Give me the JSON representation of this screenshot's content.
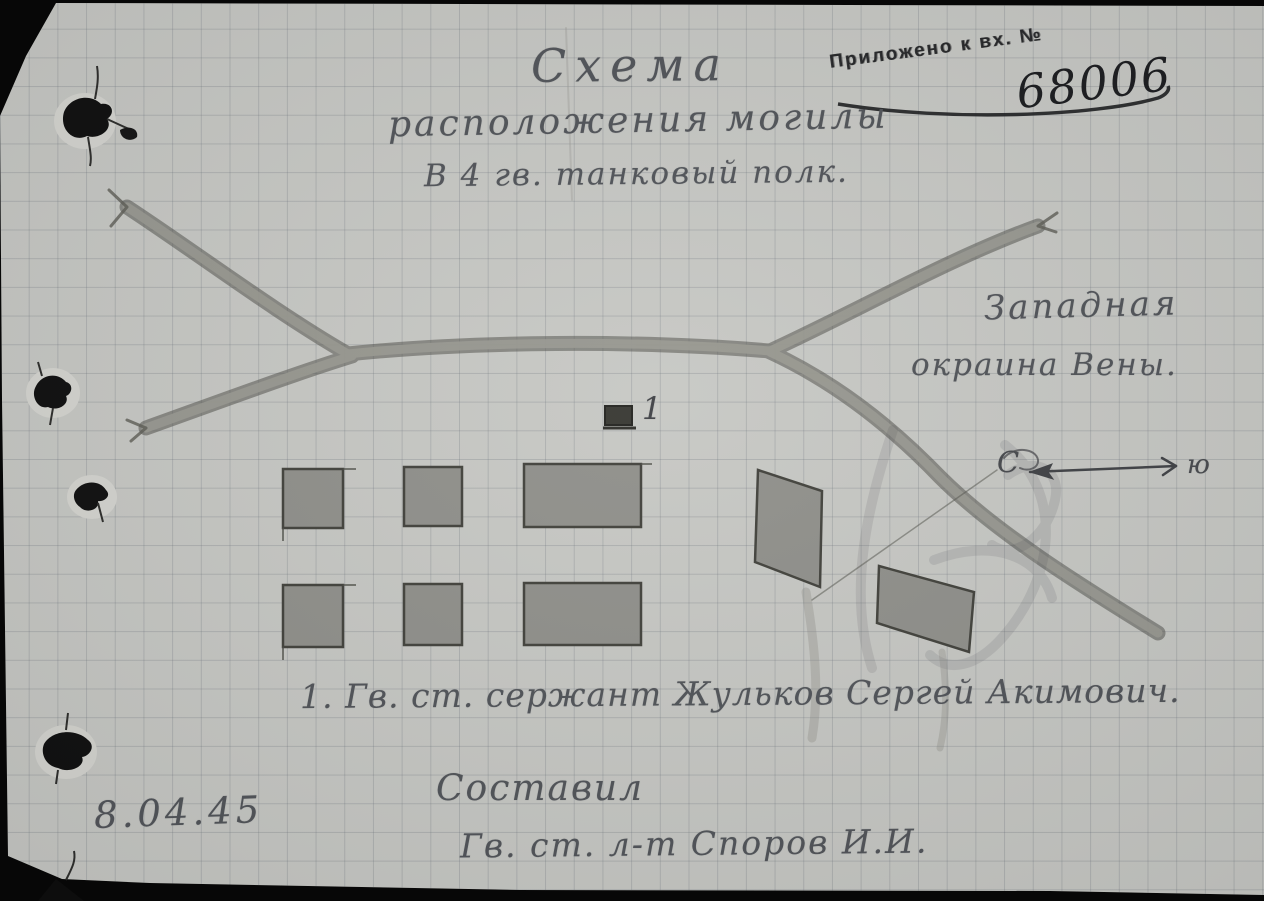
{
  "doc": {
    "stamp_label": "Приложено к вх. №",
    "stamp_number": "68006",
    "title1": "Схема",
    "title2": "расположения могилы",
    "title3": "В 4 гв. танковый полк.",
    "loc1": "Западная",
    "loc2": "окраина Вены.",
    "marker1": "1",
    "compass_n": "С",
    "compass_s": "ю",
    "legend": "1. Гв. ст. сержант Жульков Сергей Акимович.",
    "composed": "Составил",
    "author": "Гв. ст. л-т Споров И.И.",
    "date": "8.04.45",
    "colors": {
      "paper": "#c6c7c3",
      "grid": "#646c74",
      "pencil": "#4e5156",
      "road": "#8f8f89",
      "ink": "#17181b"
    }
  }
}
